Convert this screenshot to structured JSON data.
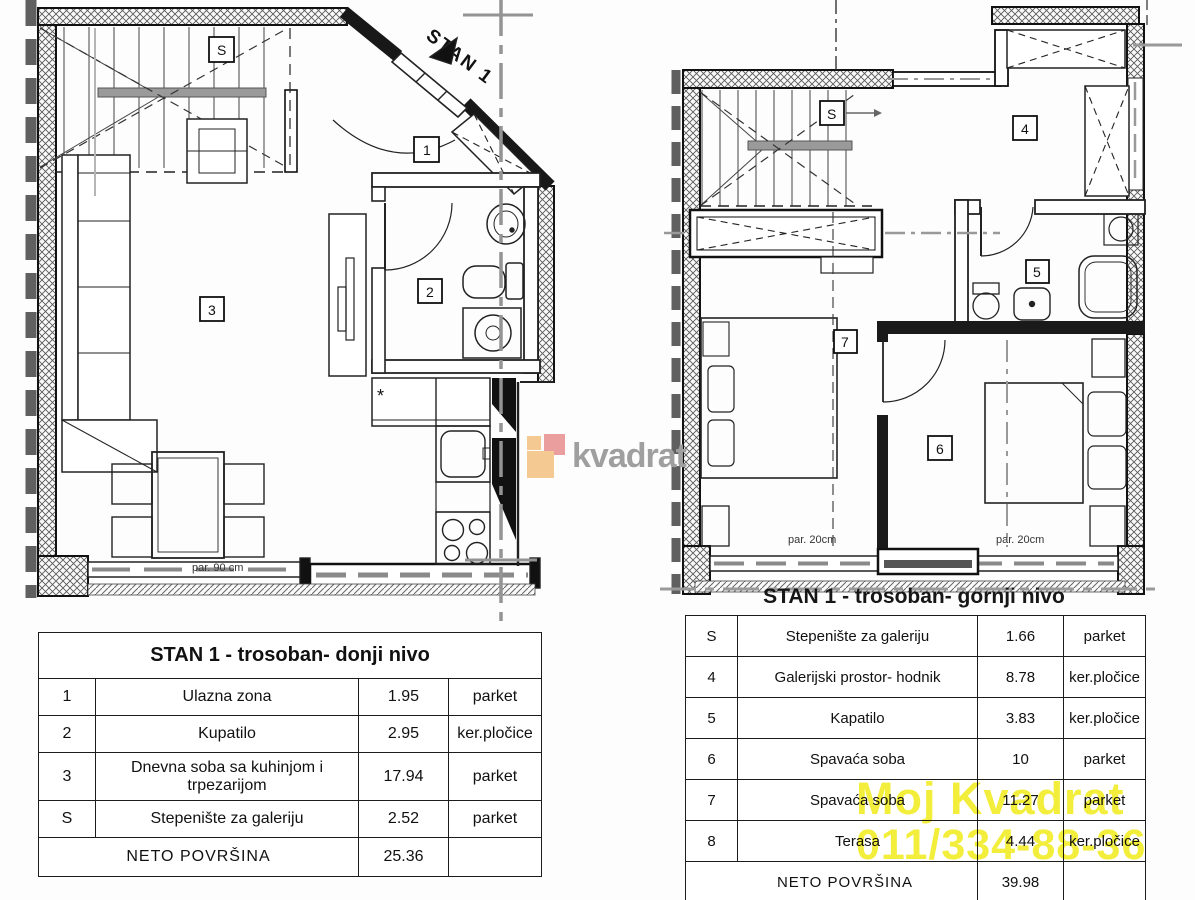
{
  "logo": {
    "text": "kvadrat",
    "colors": {
      "orange": "#f5c992",
      "red": "#ea9e9e",
      "text": "#9f9f9f"
    }
  },
  "watermark": {
    "line1": "Moj Kvadrat",
    "line2": "011/334-88-36",
    "color": "#f2ee3b"
  },
  "plans": {
    "lower": {
      "entrance_label": "STAN 1",
      "dim_note": "par. 90 cm",
      "room_labels": {
        "s": "S",
        "r1": "1",
        "r2": "2",
        "r3": "3"
      },
      "kitchen_star": "*"
    },
    "upper": {
      "caption": "STAN 1 - trosoban- gornji nivo",
      "dim_note_left": "par. 20cm",
      "dim_note_right": "par. 20cm",
      "room_labels": {
        "s": "S",
        "r4": "4",
        "r5": "5",
        "r6": "6",
        "r7": "7"
      }
    }
  },
  "tables": {
    "lower": {
      "title": "STAN 1 - trosoban- donji nivo",
      "rows": [
        {
          "num": "1",
          "name": "Ulazna zona",
          "area": "1.95",
          "floor": "parket"
        },
        {
          "num": "2",
          "name": "Kupatilo",
          "area": "2.95",
          "floor": "ker.pločice"
        },
        {
          "num": "3",
          "name": "Dnevna soba sa kuhinjom i trpezarijom",
          "area": "17.94",
          "floor": "parket"
        },
        {
          "num": "S",
          "name": "Stepenište za galeriju",
          "area": "2.52",
          "floor": "parket"
        }
      ],
      "total_label": "NETO POVRŠINA",
      "total_area": "25.36"
    },
    "upper": {
      "rows": [
        {
          "num": "S",
          "name": "Stepenište za galeriju",
          "area": "1.66",
          "floor": "parket"
        },
        {
          "num": "4",
          "name": "Galerijski prostor- hodnik",
          "area": "8.78",
          "floor": "ker.pločice"
        },
        {
          "num": "5",
          "name": "Kapatilo",
          "area": "3.83",
          "floor": "ker.pločice"
        },
        {
          "num": "6",
          "name": "Spavaća soba",
          "area": "10",
          "floor": "parket"
        },
        {
          "num": "7",
          "name": "Spavaća soba",
          "area": "11.27",
          "floor": "parket"
        },
        {
          "num": "8",
          "name": "Terasa",
          "area": "4.44",
          "floor": "ker.pločice"
        }
      ],
      "total_label": "NETO POVRŠINA",
      "total_area": "39.98"
    }
  }
}
